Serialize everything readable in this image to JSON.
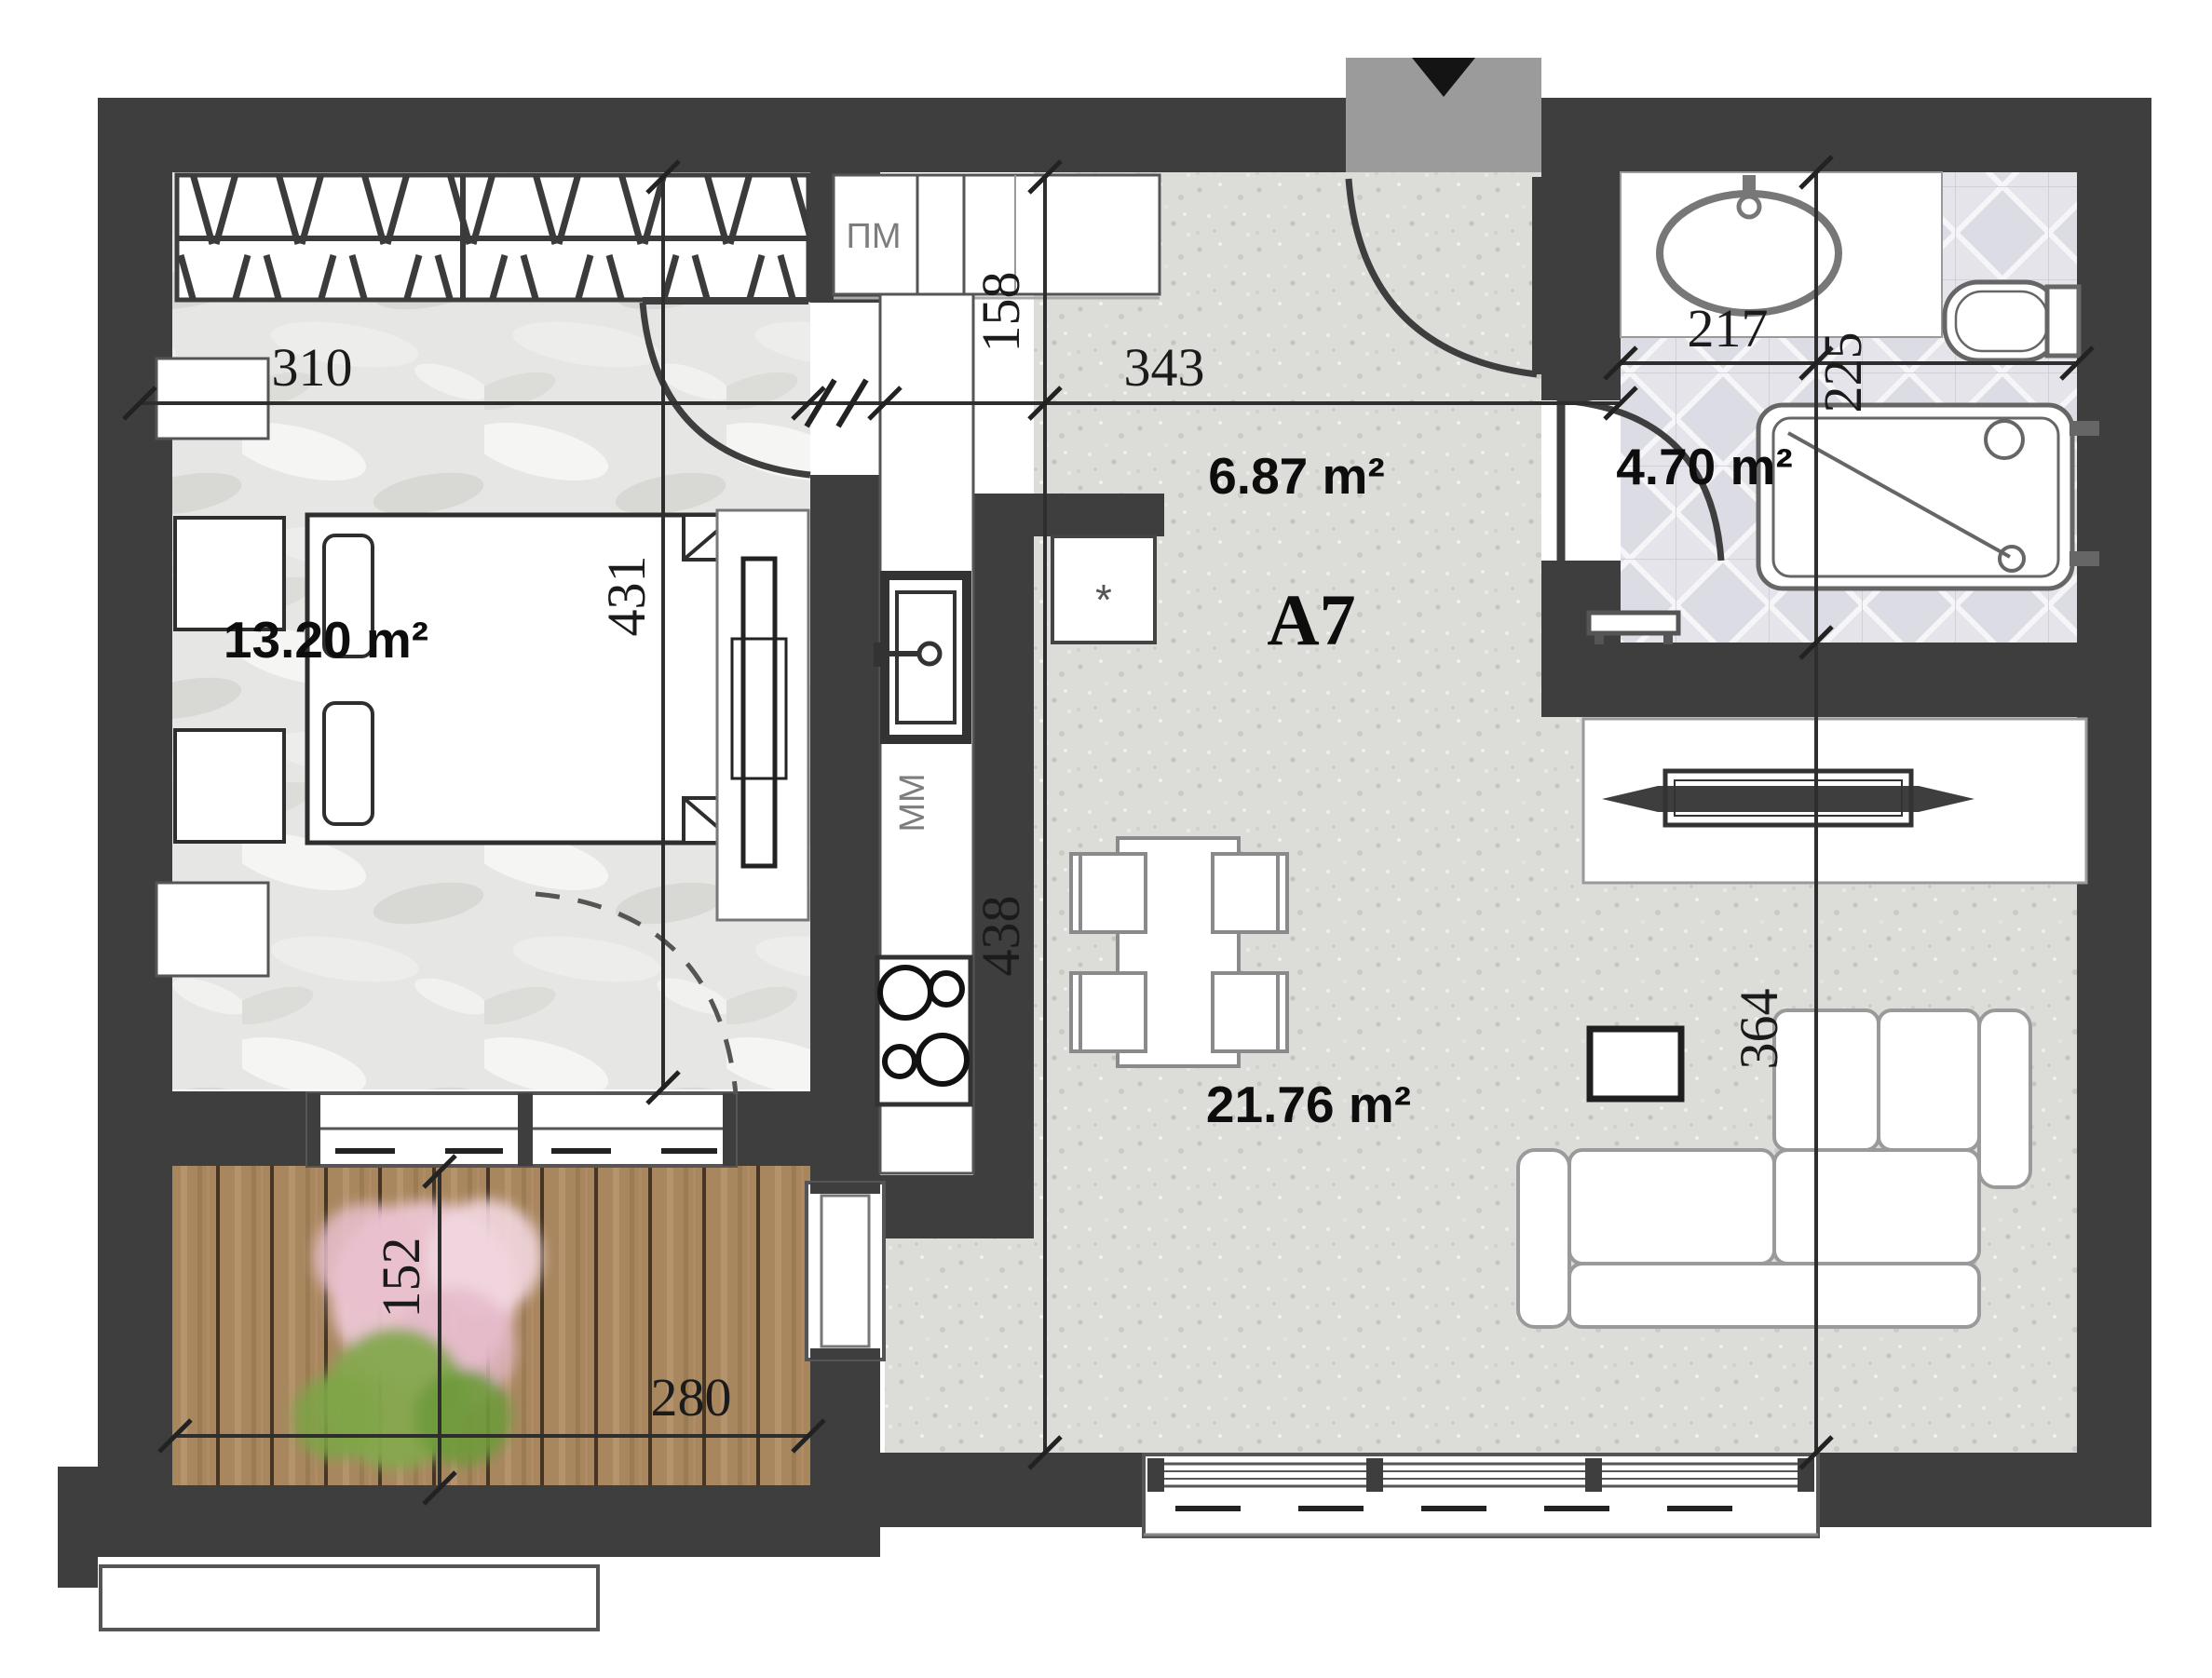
{
  "plan": {
    "unit_label": "A7",
    "rooms": {
      "bedroom": {
        "area": "13.20 m²"
      },
      "hallway": {
        "area": "6.87 m²"
      },
      "bathroom": {
        "area": "4.70 m²"
      },
      "living": {
        "area": "21.76 m²"
      }
    },
    "dimensions": {
      "bedroom_width": "310",
      "hallway_width": "343",
      "bathroom_width": "217",
      "kitchen_depth": "158",
      "bedroom_depth": "431",
      "living_depth_left": "438",
      "bathroom_depth": "225",
      "living_depth_right": "364",
      "balcony_width": "280",
      "balcony_depth": "152"
    },
    "labels": {
      "washing_machine": "ПМ",
      "dishwasher": "ММ",
      "boiler_mark": "*"
    },
    "colors": {
      "wall": "#3e3e3e",
      "floor_main": "#dcdcd8",
      "floor_bedroom": "#e6e6e4",
      "floor_wood": "#a8875f",
      "floor_tile": "#e4e4ea",
      "landing": "#9b9b9b"
    }
  }
}
